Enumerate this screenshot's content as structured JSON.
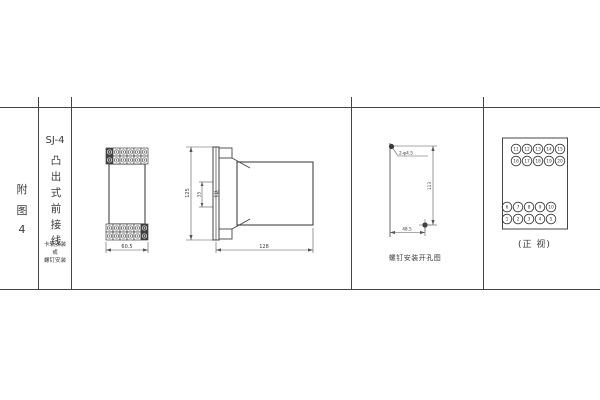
{
  "colors": {
    "line": "#444444",
    "text": "#3a3a3a",
    "background": "#ffffff"
  },
  "left_margin": {
    "figure_chars": [
      "附",
      "图",
      "4"
    ]
  },
  "title_block": {
    "model": "SJ-4",
    "mount_style_chars": [
      "凸",
      "出",
      "式",
      "前",
      "接",
      "线"
    ],
    "note_lines": [
      "卡轨安装",
      "或",
      "螺钉安装"
    ]
  },
  "front_view": {
    "width_dim": "60.5"
  },
  "side_view": {
    "height_dim": "125",
    "rail_span_dim": "35",
    "rail_label": "卡轨",
    "depth_dim": "128"
  },
  "drill_view": {
    "hole_spec": "2-φ4.5",
    "vertical_pitch_dim": "113",
    "horizontal_pitch_dim": "48.5",
    "caption": "螺钉安装开孔图"
  },
  "terminal_view": {
    "top_rows": [
      [
        "11",
        "12",
        "13",
        "14",
        "15"
      ],
      [
        "16",
        "17",
        "18",
        "19",
        "20"
      ]
    ],
    "bottom_rows": [
      [
        "6",
        "7",
        "8",
        "9",
        "10"
      ],
      [
        "1",
        "2",
        "3",
        "4",
        "5"
      ]
    ],
    "caption": "(正 视)"
  }
}
